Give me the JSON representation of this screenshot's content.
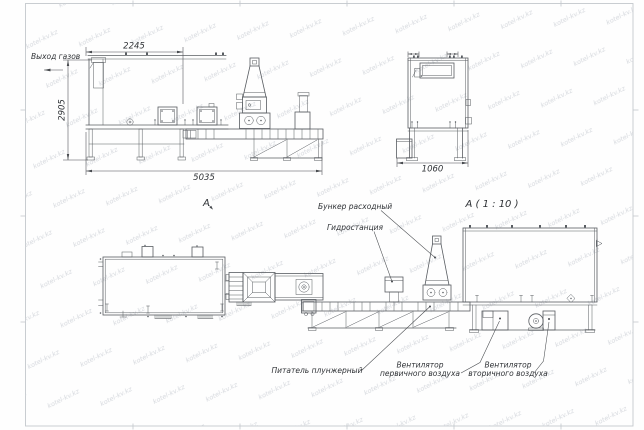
{
  "watermark": "kotel-kv.kz",
  "side_view": {
    "dim_top": "2245",
    "dim_left": "2905",
    "dim_bottom": "5035",
    "gas_outlet_label": "Выход газов"
  },
  "end_view": {
    "dim_bottom": "1060"
  },
  "plan_view": {
    "label": "A"
  },
  "detail_view": {
    "label": "A ( 1 : 10 )",
    "hopper_label": "Бункер расходный",
    "hydraulic_label": "Гидростанция",
    "feeder_label": "Питатель плунжерный",
    "fan_primary": {
      "line1": "Вентилятор",
      "line2": "первичного воздуха"
    },
    "fan_secondary": {
      "line1": "Вентилятор",
      "line2": "вторичного воздуха"
    }
  },
  "colors": {
    "line": "#585c61",
    "dim": "#46494d",
    "text": "#2f3236",
    "watermark": "#d5d8dd",
    "frame": "#c4c8cd"
  }
}
